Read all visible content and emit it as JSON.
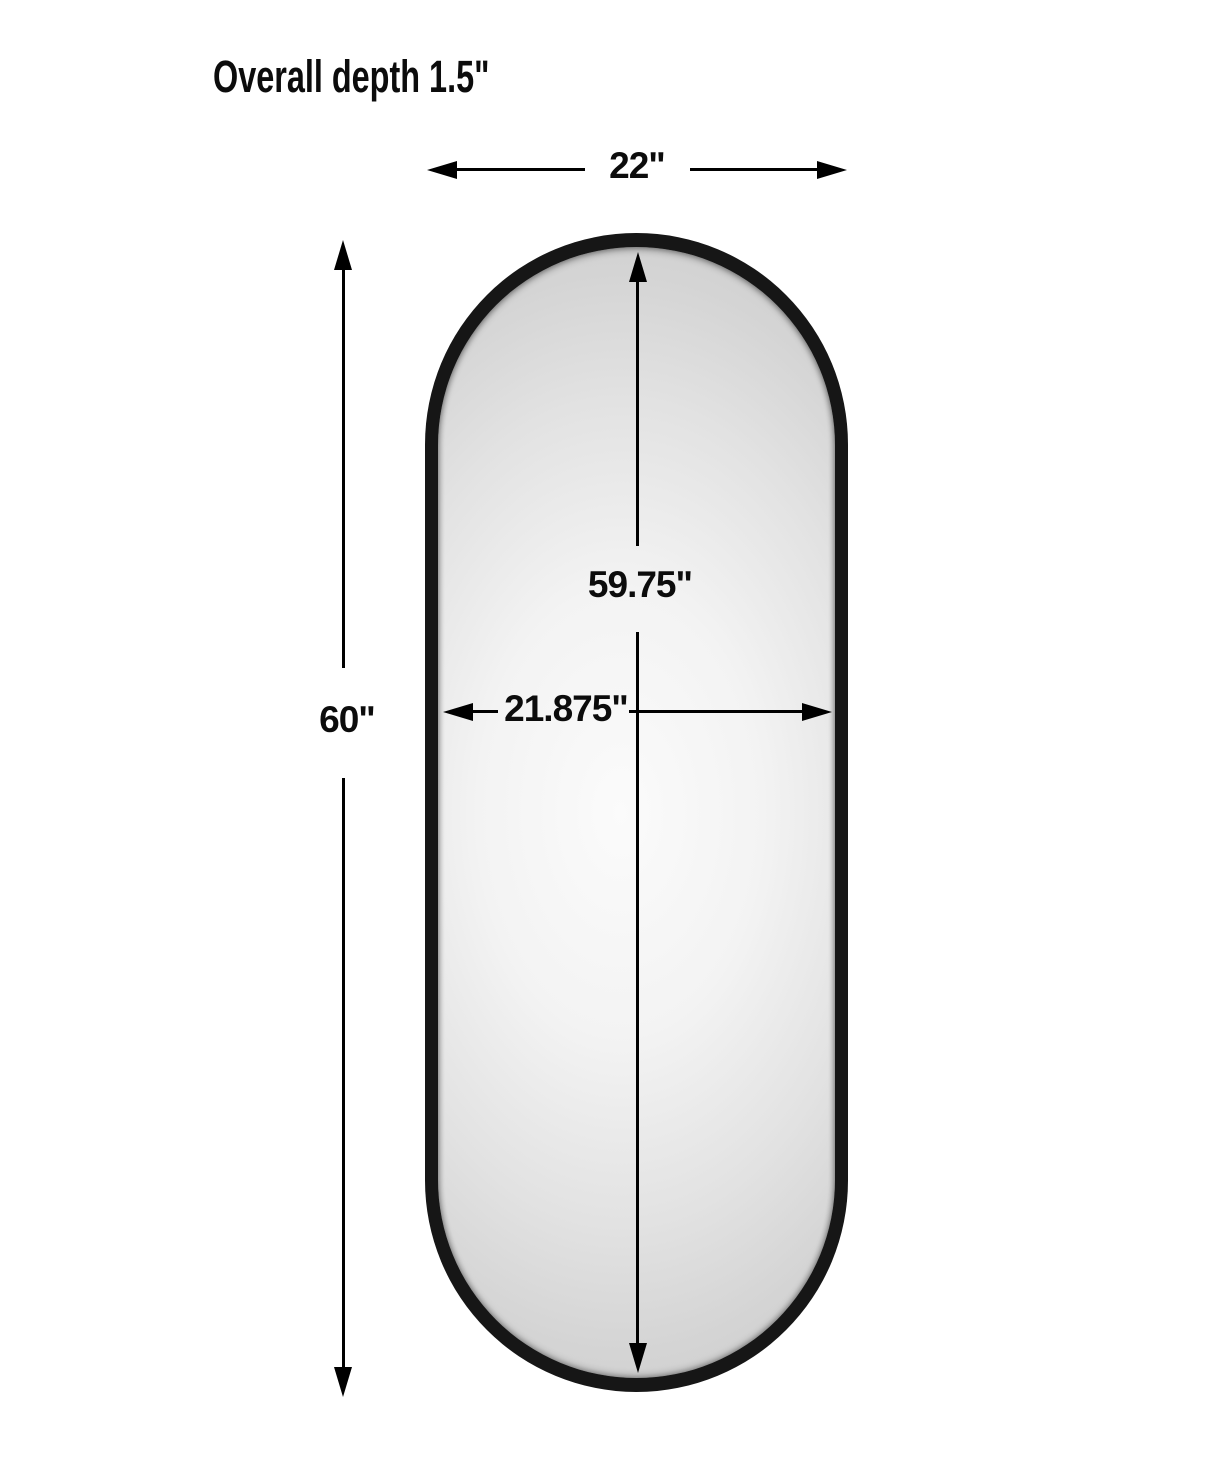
{
  "diagram": {
    "title": "Overall depth 1.5\"",
    "mirror": {
      "shape": "capsule-oval",
      "frame_color": "#161616",
      "glass_color_light": "#fbfbfb",
      "glass_color_dark": "#d0d0d0"
    },
    "dimensions": {
      "overall_depth": {
        "label": "Overall depth 1.5\"",
        "value_inches": 1.5
      },
      "overall_width": {
        "label": "22\"",
        "value_inches": 22
      },
      "overall_height": {
        "label": "60\"",
        "value_inches": 60
      },
      "glass_height": {
        "label": "59.75\"",
        "value_inches": 59.75
      },
      "glass_width": {
        "label": "21.875\"",
        "value_inches": 21.875
      }
    },
    "line_color": "#000000",
    "text_color": "#0c0c0c",
    "background": "#ffffff"
  }
}
